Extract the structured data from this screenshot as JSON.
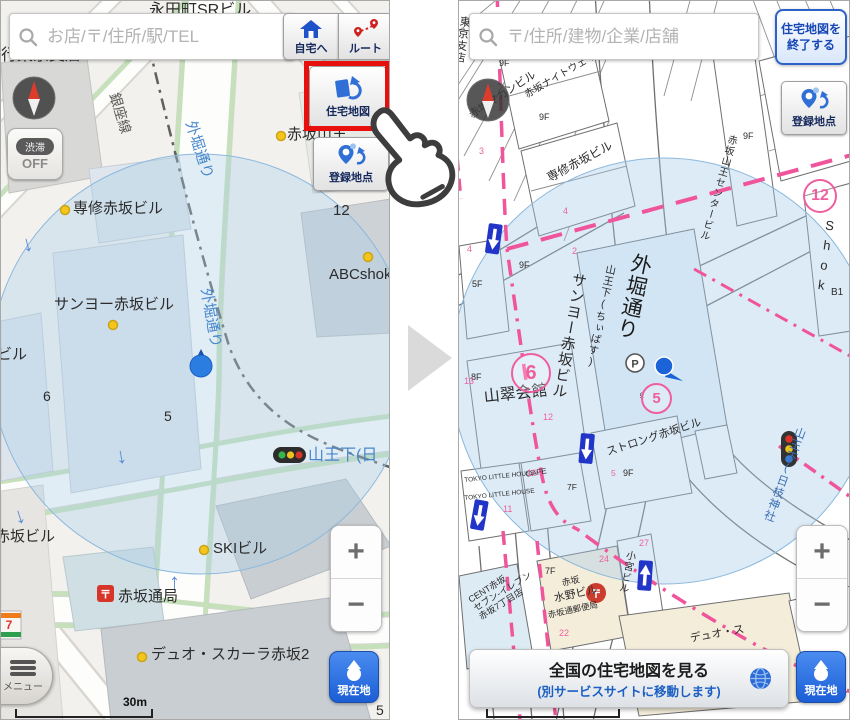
{
  "colors": {
    "accent_blue": "#2f6fd6",
    "genzaichi_blue": "#1b5ed6",
    "highlight_red": "#e8100c",
    "map_pink": "#ef5f9f",
    "road_label_blue": "#4787cd"
  },
  "left": {
    "search_placeholder": "お店/〒/住所/駅/TEL",
    "home": "自宅へ",
    "route": "ルート",
    "jutaku": "住宅地図",
    "touroku": "登録地点",
    "traffic_top": "渋滞",
    "traffic_bottom": "OFF",
    "menu": "メニュー",
    "genzaichi": "現在地",
    "zoom_in": "+",
    "zoom_out": "−",
    "scale": "30m",
    "labels": {
      "nagatacho": "永田町SRビル",
      "tokyo_shiten": "行東京支店",
      "ginza": "銀座線",
      "sotobori": "外堀通り",
      "senshu": "専修赤坂ビル",
      "n12": "12",
      "abc": "ABCshok",
      "sanyo": "サンヨー赤坂ビル",
      "biru": "ビル",
      "n6": "6",
      "n5": "5",
      "sanno": "山王下(日",
      "akasaka_biru": "赤坂ビル",
      "ski": "SKIビル",
      "tsukyoku": "赤坂通局",
      "duo": "デュオ・スカーラ赤坂2",
      "s": "S",
      "akasaka_sanno": "赤坂山王",
      "seven": "7",
      "post": "〒"
    }
  },
  "right": {
    "search_placeholder": "〒/住所/建物/企業/店舗",
    "exit1": "住宅地図を",
    "exit2": "終了する",
    "touroku": "登録地点",
    "genzaichi": "現在地",
    "zoom_in": "+",
    "zoom_out": "−",
    "scale": "30m",
    "bottom1": "全国の住宅地図を見る",
    "bottom2": "(別サービスサイトに移動します)",
    "labels": {
      "shiten": "東京支店",
      "makan": "赤坂マカンビル",
      "nightway": "赤坂ナイトウェイビル",
      "senshu": "専修赤坂ビル",
      "sanyo": "サンヨー赤坂ビル",
      "sotobori": "外堀通り",
      "chiibasu": "山王下(ちぃばす)",
      "bus": "♀",
      "sansui": "山翠会館",
      "strong": "ストロング赤坂ビル",
      "tlh": "TOKYO LITTLE HOUSE",
      "cafe": "CAFE",
      "center_b": "赤坂山王センタービル",
      "shok": "Shok",
      "b1": "B1",
      "sanno_hie": "山王下(日枝神社",
      "cent1": "CENT赤坂",
      "cent2": "セブン-イレブン",
      "cent3": "赤坂7丁目店",
      "m7f": "7F",
      "mizuno1": "赤坂",
      "mizuno2": "水野ビル",
      "mizuno3": "赤坂通郵便局",
      "komiya": "小宮ビル",
      "duo": "デュオ・ス",
      "p": "P",
      "post": "〒",
      "c6": "6",
      "c5": "5",
      "c12": "12",
      "f9": "9F",
      "f8": "8F",
      "f7": "7F",
      "f5": "5F",
      "l2": "2",
      "l3": "3",
      "l4": "4",
      "l10": "10",
      "l11": "11",
      "l12": "12",
      "l13": "13",
      "l22": "22",
      "l24": "24",
      "l27": "27",
      "l5": "5"
    }
  }
}
